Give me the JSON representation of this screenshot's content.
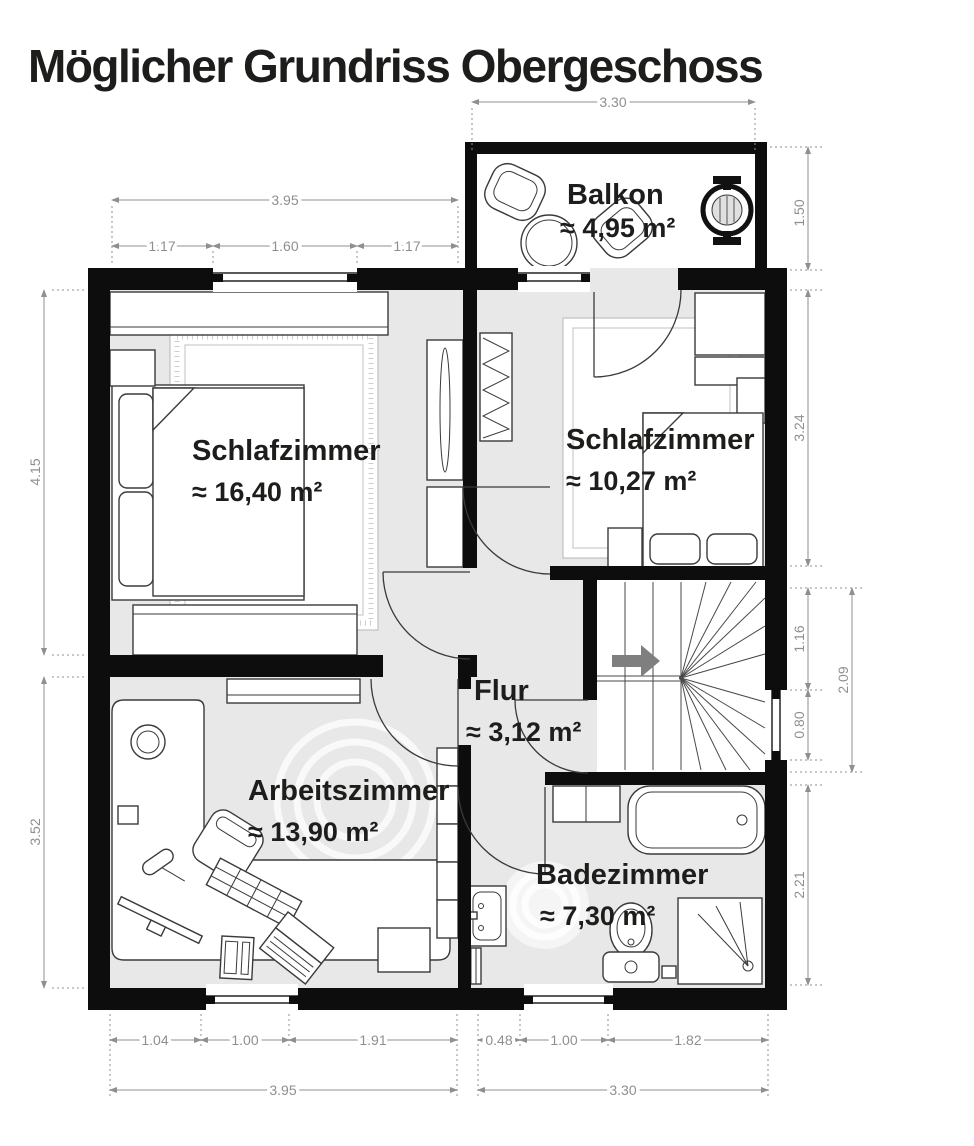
{
  "header": {
    "title": "Möglicher Grundriss Obergeschoss"
  },
  "rooms": [
    {
      "id": "balkon",
      "name": "Balkon",
      "area": "≈ 4,95 m²"
    },
    {
      "id": "schlafzimmer1",
      "name": "Schlafzimmer",
      "area": "≈ 16,40 m²"
    },
    {
      "id": "schlafzimmer2",
      "name": "Schlafzimmer",
      "area": "≈ 10,27 m²"
    },
    {
      "id": "flur",
      "name": "Flur",
      "area": "≈ 3,12 m²"
    },
    {
      "id": "arbeitszimmer",
      "name": "Arbeitszimmer",
      "area": "≈ 13,90 m²"
    },
    {
      "id": "badezimmer",
      "name": "Badezimmer",
      "area": "≈ 7,30 m²"
    }
  ],
  "dims": {
    "top": {
      "balcony_width": "3.30",
      "bedroom_total": "3.95",
      "bedroom_left": "1.17",
      "bedroom_window": "1.60",
      "bedroom_right": "1.17"
    },
    "right": {
      "balcony_height": "1.50",
      "bedroom2_height": "3.24",
      "stair_upper": "1.16",
      "stair_window": "0.80",
      "stair_total": "2.09",
      "bath_height": "2.21"
    },
    "left": {
      "bedroom1_height": "4.15",
      "study_height": "3.52"
    },
    "bottom": {
      "study_left": "1.04",
      "study_window": "1.00",
      "study_right": "1.91",
      "bath_left": "0.48",
      "bath_window": "1.00",
      "bath_right": "1.82",
      "left_total": "3.95",
      "right_total": "3.30"
    }
  },
  "icons": {
    "stair_arrow": "direction-of-stairs"
  },
  "colors": {
    "wall": "#0d0d0d",
    "floor": "#e8e8e8",
    "stroke": "#3a3a3a",
    "dim": "#8f8f8f",
    "arrow": "#7f7f7f",
    "label": "#1d1d1b",
    "rug": "#c0c0c0"
  }
}
